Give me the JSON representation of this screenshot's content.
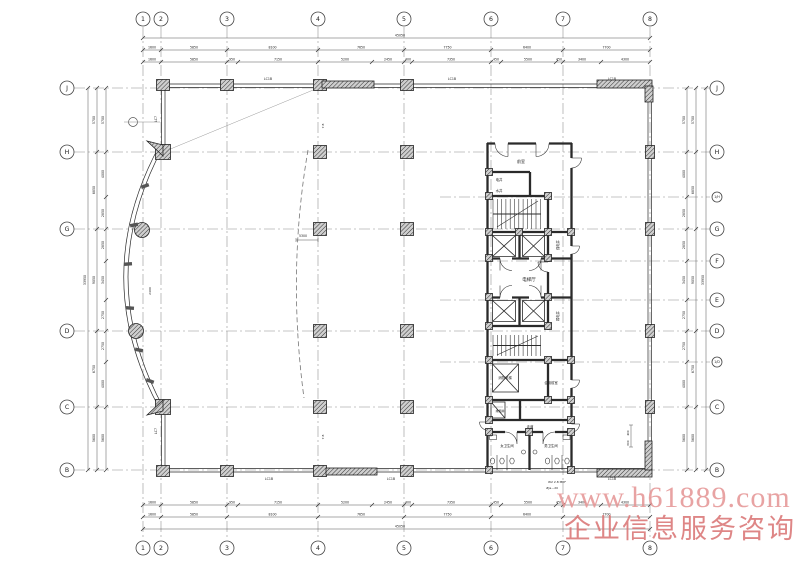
{
  "watermark": {
    "line1": "www.h61889.com",
    "line2": "企业信息服务咨询",
    "color1": "#e59494",
    "color2": "#d97272"
  },
  "grid": {
    "cols": [
      {
        "label": "1",
        "x": 143
      },
      {
        "label": "2",
        "x": 161
      },
      {
        "label": "3",
        "x": 227
      },
      {
        "label": "4",
        "x": 318
      },
      {
        "label": "5",
        "x": 404
      },
      {
        "label": "6",
        "x": 491
      },
      {
        "label": "7",
        "x": 563
      },
      {
        "label": "8",
        "x": 650
      }
    ],
    "rows": [
      {
        "label": "J",
        "y": 88,
        "left": true
      },
      {
        "label": "H",
        "y": 152,
        "left": true
      },
      {
        "label": "1/H",
        "y": 197,
        "small": true
      },
      {
        "label": "G",
        "y": 229,
        "left": true
      },
      {
        "label": "F",
        "y": 261
      },
      {
        "label": "E",
        "y": 300
      },
      {
        "label": "D",
        "y": 331,
        "left": true
      },
      {
        "label": "1/D",
        "y": 362,
        "small": true
      },
      {
        "label": "C",
        "y": 407,
        "left": true
      },
      {
        "label": "B",
        "y": 470,
        "left": true
      }
    ]
  },
  "dims": {
    "top_overall": "45050",
    "bottom_overall": "45050",
    "left_overall": "33950",
    "right_overall": "33950",
    "top_major": [
      "1600",
      "5850",
      "8100",
      "7650",
      "7750",
      "6400",
      "7700"
    ],
    "top_minor": [
      {
        "x": 152,
        "t": "1600"
      },
      {
        "x": 194,
        "t": "5850"
      },
      {
        "x": 232,
        "t": "950"
      },
      {
        "x": 278,
        "t": "7150"
      },
      {
        "x": 345,
        "t": "5200"
      },
      {
        "x": 388,
        "t": "2450"
      },
      {
        "x": 408,
        "t": "400"
      },
      {
        "x": 451,
        "t": "7350"
      },
      {
        "x": 496,
        "t": "450"
      },
      {
        "x": 528,
        "t": "5500"
      },
      {
        "x": 559,
        "t": "450"
      },
      {
        "x": 582,
        "t": "3400"
      },
      {
        "x": 625,
        "t": "4300"
      }
    ],
    "side_major": [
      {
        "y": 120,
        "t": "5700"
      },
      {
        "y": 190,
        "t": "6850"
      },
      {
        "y": 280,
        "t": "9050"
      },
      {
        "y": 369,
        "t": "6750"
      },
      {
        "y": 438,
        "t": "5600"
      }
    ],
    "side_minor": [
      {
        "y": 120,
        "t": "5700"
      },
      {
        "y": 174,
        "t": "4000"
      },
      {
        "y": 213,
        "t": "2850"
      },
      {
        "y": 245,
        "t": "2850"
      },
      {
        "y": 280,
        "t": "3450"
      },
      {
        "y": 315,
        "t": "2750"
      },
      {
        "y": 346,
        "t": "2750"
      },
      {
        "y": 384,
        "t": "4000"
      },
      {
        "y": 438,
        "t": "5600"
      }
    ]
  },
  "rooms": [
    {
      "t": "前室",
      "x": 521,
      "y": 163,
      "s": 4
    },
    {
      "t": "电井",
      "x": 499,
      "y": 181,
      "s": 3.4
    },
    {
      "t": "水井",
      "x": 499,
      "y": 192,
      "s": 3.4
    },
    {
      "t": "电梯厅",
      "x": 529,
      "y": 281,
      "s": 4.5
    },
    {
      "t": "强电井",
      "x": 559,
      "y": 245,
      "s": 3.4,
      "rot": -90
    },
    {
      "t": "弱电井",
      "x": 559,
      "y": 316,
      "s": 3.4,
      "rot": -90
    },
    {
      "t": "消防电梯",
      "x": 505,
      "y": 379,
      "s": 3.4
    },
    {
      "t": "合用前室",
      "x": 551,
      "y": 384,
      "s": 3.4
    },
    {
      "t": "排烟井",
      "x": 500,
      "y": 412,
      "s": 3
    },
    {
      "t": "走道",
      "x": 530,
      "y": 428,
      "s": 3.4
    },
    {
      "t": "女卫生间",
      "x": 507,
      "y": 447,
      "s": 3.4
    },
    {
      "t": "男卫生间",
      "x": 551,
      "y": 447,
      "s": 3.4
    }
  ],
  "tags": [
    {
      "t": "LC1B",
      "x": 268,
      "y": 80,
      "s": 3.2
    },
    {
      "t": "LC1B",
      "x": 452,
      "y": 80,
      "s": 3.2
    },
    {
      "t": "LC1B",
      "x": 612,
      "y": 80,
      "s": 3.2
    },
    {
      "t": "LC1B",
      "x": 269,
      "y": 480,
      "s": 3.2
    },
    {
      "t": "LC1B",
      "x": 391,
      "y": 480,
      "s": 3.2
    },
    {
      "t": "LC1B",
      "x": 612,
      "y": 480,
      "s": 3.2
    },
    {
      "t": "LC7",
      "x": 157,
      "y": 119,
      "s": 3.2,
      "rot": -90
    },
    {
      "t": "LC7",
      "x": 157,
      "y": 431,
      "s": 3.2,
      "rot": -90
    },
    {
      "t": "5300",
      "x": 303,
      "y": 237,
      "s": 3.2
    },
    {
      "t": "7.8",
      "x": 324,
      "y": 126,
      "s": 3,
      "rot": -90
    },
    {
      "t": "7.8",
      "x": 324,
      "y": 437,
      "s": 3,
      "rot": -90
    },
    {
      "t": "2400",
      "x": 151,
      "y": 291,
      "s": 3,
      "rot": -90
    },
    {
      "t": "W2 2.8 MRF",
      "x": 557,
      "y": 483,
      "s": 3
    },
    {
      "t": "#Ja—20",
      "x": 552,
      "y": 489,
      "s": 3
    },
    {
      "t": "400",
      "x": 629,
      "y": 433,
      "s": 2.8,
      "rot": -90
    },
    {
      "t": "600",
      "x": 629,
      "y": 443,
      "s": 2.8,
      "rot": -90
    }
  ]
}
